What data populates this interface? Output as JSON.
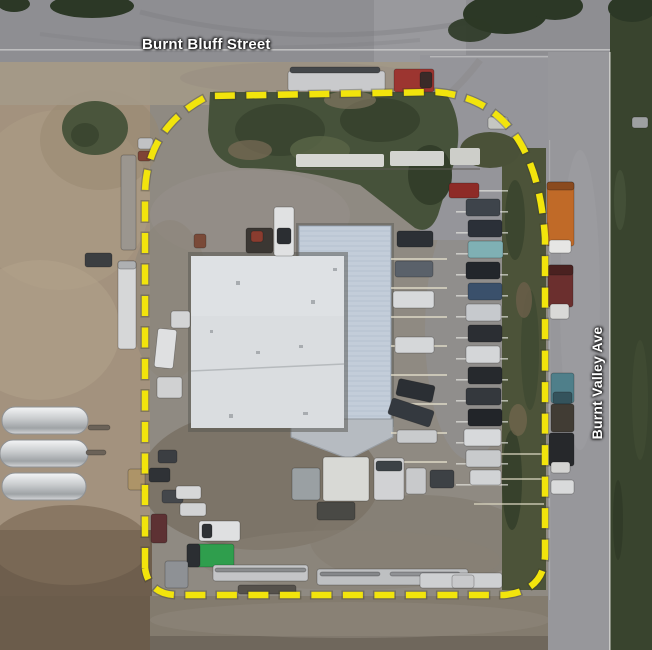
{
  "labels": {
    "street_top": "Burnt Bluff Street",
    "street_right": "Burnt Valley Ave"
  },
  "colors": {
    "boundary": "#f2e40c",
    "boundary_halo": "#3a3a20",
    "label_text": "#ffffff",
    "roof": "#dadde0",
    "canopy": "#c3cdd9",
    "grass": "#4c5339",
    "dirt": "#a3927e",
    "road": "#8e8e92"
  },
  "scene": {
    "tanks": [
      {
        "x": 2,
        "y": 407,
        "w": 86,
        "h": 27
      },
      {
        "x": 0,
        "y": 440,
        "w": 88,
        "h": 27
      },
      {
        "x": 2,
        "y": 473,
        "w": 84,
        "h": 27
      }
    ],
    "parking_rows": [
      {
        "x1": 456,
        "x2": 508,
        "y": 190,
        "gap": 21,
        "count": 15,
        "color": "#e9e9e3",
        "w": 1.6,
        "o": 0.65
      },
      {
        "x1": 391,
        "x2": 447,
        "y": 258,
        "gap": 29,
        "count": 8,
        "color": "#ddd8c6",
        "w": 2,
        "o": 0.75
      },
      {
        "x1": 474,
        "x2": 544,
        "y": 453,
        "gap": 25,
        "count": 3,
        "color": "#d9d4be",
        "w": 2,
        "o": 0.65
      }
    ],
    "vehicles": [
      {
        "x": 288,
        "y": 71,
        "w": 97,
        "h": 20,
        "c": "#c9cacc"
      },
      {
        "x": 290,
        "y": 67,
        "w": 90,
        "h": 6,
        "c": "#44474a"
      },
      {
        "x": 394,
        "y": 69,
        "w": 40,
        "h": 23,
        "c": "#9c3530"
      },
      {
        "x": 420,
        "y": 72,
        "w": 12,
        "h": 16,
        "c": "#3a2a28"
      },
      {
        "x": 547,
        "y": 182,
        "w": 27,
        "h": 64,
        "c": "#c06a28"
      },
      {
        "x": 547,
        "y": 182,
        "w": 27,
        "h": 8,
        "c": "#8a4a1e"
      },
      {
        "x": 549,
        "y": 240,
        "w": 22,
        "h": 13,
        "c": "#e6e6e4"
      },
      {
        "x": 548,
        "y": 265,
        "w": 25,
        "h": 42,
        "c": "#6b2f2e"
      },
      {
        "x": 548,
        "y": 265,
        "w": 25,
        "h": 10,
        "c": "#4a2120"
      },
      {
        "x": 550,
        "y": 304,
        "w": 19,
        "h": 15,
        "c": "#d9d9d7"
      },
      {
        "x": 551,
        "y": 373,
        "w": 23,
        "h": 30,
        "c": "#4f7f8a"
      },
      {
        "x": 553,
        "y": 392,
        "w": 19,
        "h": 12,
        "c": "#34535c"
      },
      {
        "x": 551,
        "y": 404,
        "w": 23,
        "h": 28,
        "c": "#413c34"
      },
      {
        "x": 549,
        "y": 433,
        "w": 25,
        "h": 33,
        "c": "#26282b"
      },
      {
        "x": 551,
        "y": 462,
        "w": 19,
        "h": 11,
        "c": "#d4d4d2"
      },
      {
        "x": 551,
        "y": 480,
        "w": 23,
        "h": 14,
        "c": "#d9dadb"
      },
      {
        "x": 449,
        "y": 183,
        "w": 30,
        "h": 15,
        "c": "#8e2b27"
      },
      {
        "x": 466,
        "y": 199,
        "w": 34,
        "h": 17,
        "c": "#3e444b"
      },
      {
        "x": 468,
        "y": 220,
        "w": 34,
        "h": 17,
        "c": "#2b3038"
      },
      {
        "x": 468,
        "y": 241,
        "w": 35,
        "h": 17,
        "c": "#7fb0b4"
      },
      {
        "x": 466,
        "y": 262,
        "w": 34,
        "h": 17,
        "c": "#22262b"
      },
      {
        "x": 468,
        "y": 283,
        "w": 34,
        "h": 17,
        "c": "#3a506b"
      },
      {
        "x": 466,
        "y": 304,
        "w": 35,
        "h": 17,
        "c": "#c6c9cd"
      },
      {
        "x": 468,
        "y": 325,
        "w": 34,
        "h": 17,
        "c": "#2b2e33"
      },
      {
        "x": 466,
        "y": 346,
        "w": 34,
        "h": 17,
        "c": "#d4d6d8"
      },
      {
        "x": 468,
        "y": 367,
        "w": 34,
        "h": 17,
        "c": "#26292d"
      },
      {
        "x": 466,
        "y": 388,
        "w": 35,
        "h": 17,
        "c": "#34383d"
      },
      {
        "x": 468,
        "y": 409,
        "w": 34,
        "h": 17,
        "c": "#222529"
      },
      {
        "x": 464,
        "y": 429,
        "w": 37,
        "h": 17,
        "c": "#d7d9db"
      },
      {
        "x": 466,
        "y": 450,
        "w": 35,
        "h": 17,
        "c": "#c8cacc"
      },
      {
        "x": 470,
        "y": 470,
        "w": 31,
        "h": 15,
        "c": "#d1d3d5"
      },
      {
        "x": 397,
        "y": 231,
        "w": 36,
        "h": 16,
        "c": "#2c3035"
      },
      {
        "x": 395,
        "y": 261,
        "w": 38,
        "h": 16,
        "c": "#5a616a"
      },
      {
        "x": 393,
        "y": 291,
        "w": 41,
        "h": 17,
        "c": "#d7d9db"
      },
      {
        "x": 395,
        "y": 337,
        "w": 39,
        "h": 16,
        "c": "#d5d7d9"
      },
      {
        "x": 397,
        "y": 382,
        "w": 37,
        "h": 17,
        "c": "#2b2f34",
        "r": 12
      },
      {
        "x": 389,
        "y": 404,
        "w": 44,
        "h": 17,
        "c": "#34393f",
        "r": 18
      },
      {
        "x": 397,
        "y": 430,
        "w": 40,
        "h": 13,
        "c": "#c9cbcd"
      },
      {
        "x": 274,
        "y": 207,
        "w": 20,
        "h": 49,
        "c": "#e0e1e2"
      },
      {
        "x": 277,
        "y": 228,
        "w": 14,
        "h": 16,
        "c": "#2b2e32"
      },
      {
        "x": 246,
        "y": 228,
        "w": 27,
        "h": 25,
        "c": "#3b3733"
      },
      {
        "x": 251,
        "y": 231,
        "w": 12,
        "h": 11,
        "c": "#8a3c2f"
      },
      {
        "x": 194,
        "y": 234,
        "w": 12,
        "h": 14,
        "c": "#7a4a38"
      },
      {
        "x": 488,
        "y": 117,
        "w": 20,
        "h": 12,
        "c": "#c5c6c2"
      },
      {
        "x": 632,
        "y": 117,
        "w": 16,
        "h": 11,
        "c": "#9ea0a2"
      },
      {
        "x": 121,
        "y": 155,
        "w": 15,
        "h": 95,
        "c": "#9b968f"
      },
      {
        "x": 118,
        "y": 261,
        "w": 18,
        "h": 88,
        "c": "#d6d7d8"
      },
      {
        "x": 118,
        "y": 261,
        "w": 18,
        "h": 8,
        "c": "#aeb0b2"
      },
      {
        "x": 156,
        "y": 329,
        "w": 19,
        "h": 39,
        "c": "#dfe0e1",
        "r": 6
      },
      {
        "x": 171,
        "y": 311,
        "w": 19,
        "h": 17,
        "c": "#d3d4d5"
      },
      {
        "x": 157,
        "y": 377,
        "w": 25,
        "h": 21,
        "c": "#d0d1d2"
      },
      {
        "x": 85,
        "y": 253,
        "w": 27,
        "h": 14,
        "c": "#3b3e41"
      },
      {
        "x": 138,
        "y": 138,
        "w": 15,
        "h": 11,
        "c": "#c1c2c4"
      },
      {
        "x": 138,
        "y": 151,
        "w": 13,
        "h": 10,
        "c": "#7e4436"
      },
      {
        "x": 88,
        "y": 425,
        "w": 22,
        "h": 5,
        "c": "#6b6258"
      },
      {
        "x": 86,
        "y": 450,
        "w": 20,
        "h": 5,
        "c": "#6b6258"
      },
      {
        "x": 292,
        "y": 468,
        "w": 28,
        "h": 32,
        "c": "#9aa0a3"
      },
      {
        "x": 323,
        "y": 457,
        "w": 46,
        "h": 44,
        "c": "#d8d9d5"
      },
      {
        "x": 374,
        "y": 458,
        "w": 30,
        "h": 42,
        "c": "#d1d2d4"
      },
      {
        "x": 376,
        "y": 461,
        "w": 26,
        "h": 10,
        "c": "#3c4246"
      },
      {
        "x": 317,
        "y": 502,
        "w": 38,
        "h": 18,
        "c": "#494945"
      },
      {
        "x": 406,
        "y": 468,
        "w": 20,
        "h": 26,
        "c": "#c8c9cb"
      },
      {
        "x": 430,
        "y": 470,
        "w": 24,
        "h": 18,
        "c": "#3d4145"
      },
      {
        "x": 128,
        "y": 469,
        "w": 17,
        "h": 21,
        "c": "#ad9468"
      },
      {
        "x": 158,
        "y": 450,
        "w": 19,
        "h": 13,
        "c": "#3b3e42"
      },
      {
        "x": 149,
        "y": 468,
        "w": 21,
        "h": 14,
        "c": "#2f3236"
      },
      {
        "x": 162,
        "y": 490,
        "w": 21,
        "h": 13,
        "c": "#44474b"
      },
      {
        "x": 176,
        "y": 486,
        "w": 25,
        "h": 13,
        "c": "#d6d7d8"
      },
      {
        "x": 180,
        "y": 503,
        "w": 26,
        "h": 13,
        "c": "#d2d3d4"
      },
      {
        "x": 151,
        "y": 514,
        "w": 16,
        "h": 29,
        "c": "#5d3133"
      },
      {
        "x": 199,
        "y": 521,
        "w": 41,
        "h": 20,
        "c": "#dfe0e1"
      },
      {
        "x": 202,
        "y": 524,
        "w": 10,
        "h": 14,
        "c": "#2e3134"
      },
      {
        "x": 187,
        "y": 544,
        "w": 47,
        "h": 23,
        "c": "#2f9e4d"
      },
      {
        "x": 187,
        "y": 544,
        "w": 13,
        "h": 23,
        "c": "#2b2e32"
      },
      {
        "x": 165,
        "y": 561,
        "w": 23,
        "h": 27,
        "c": "#8e9195"
      },
      {
        "x": 213,
        "y": 565,
        "w": 95,
        "h": 16,
        "c": "#c4c5c7"
      },
      {
        "x": 215,
        "y": 568,
        "w": 91,
        "h": 4,
        "c": "#8b8d8f"
      },
      {
        "x": 317,
        "y": 569,
        "w": 151,
        "h": 16,
        "c": "#bec0c2"
      },
      {
        "x": 320,
        "y": 572,
        "w": 60,
        "h": 4,
        "c": "#85878a"
      },
      {
        "x": 390,
        "y": 572,
        "w": 70,
        "h": 4,
        "c": "#909295"
      },
      {
        "x": 420,
        "y": 573,
        "w": 82,
        "h": 15,
        "c": "#ced0d2"
      },
      {
        "x": 238,
        "y": 585,
        "w": 58,
        "h": 9,
        "c": "#55514b"
      },
      {
        "x": 452,
        "y": 575,
        "w": 22,
        "h": 13,
        "c": "#c8c9cb"
      }
    ]
  }
}
